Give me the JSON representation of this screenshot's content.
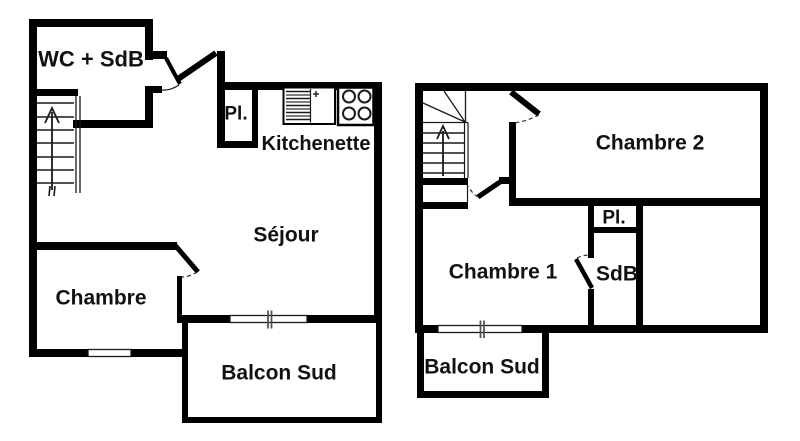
{
  "image": {
    "type": "apartment floor plans (duplex, two levels)",
    "background_color": "#ffffff",
    "wall_color": "#000000",
    "label_color": "#111111",
    "mullion_color": "#555555"
  },
  "ground_floor": {
    "rooms": {
      "wc_sdb": "WC + SdB",
      "closet": "Pl.",
      "kitchenette": "Kitchenette",
      "living_room": "Séjour",
      "bedroom": "Chambre",
      "balcony": "Balcon Sud"
    },
    "features": {
      "staircase": "straight-stairs-up-arrow",
      "kitchen_icons": [
        "sink-drainer-icon",
        "stove-4-burner-icon"
      ],
      "door_count": 3,
      "window_count": 2
    }
  },
  "upper_floor": {
    "rooms": {
      "bedroom2": "Chambre 2",
      "closet": "Pl.",
      "bedroom1": "Chambre 1",
      "bathroom": "SdB",
      "balcony": "Balcon Sud"
    },
    "features": {
      "staircase": "winder-stairs-up-arrow",
      "door_count": 3,
      "window_count": 1
    }
  }
}
